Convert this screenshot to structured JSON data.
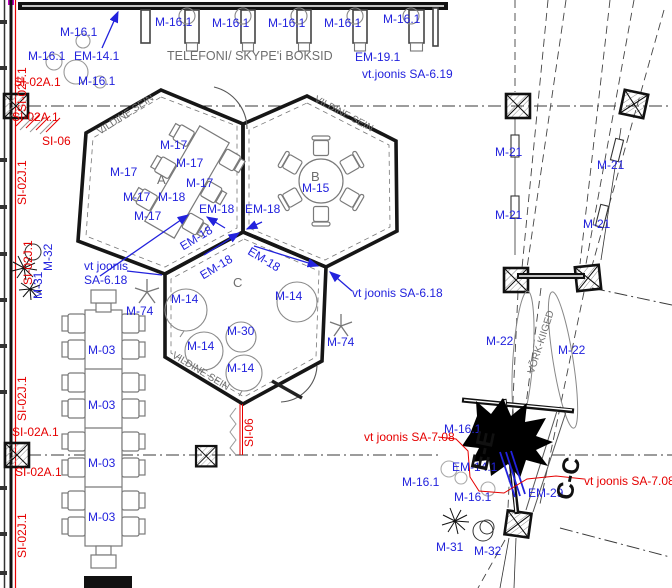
{
  "colors": {
    "annotation_blue": "#2222dd",
    "annotation_red": "#e60000",
    "annotation_gray": "#6e6e6e",
    "wall_black": "#161616",
    "wall_tick_magenta": "#c400c4"
  },
  "rooms": [
    "A",
    "B",
    "C"
  ],
  "phone_booths": {
    "title": "TELEFONI/ SKYPE'i BOKSID",
    "booth_label": "M-16.1",
    "booth_count": 5,
    "reference": "EM-19.1",
    "reference_note": "vt.joonis SA-6.19"
  },
  "annotations": {
    "top_left": [
      {
        "t": "M-16.1",
        "x": 60,
        "y": 26,
        "c": "blue"
      },
      {
        "t": "M-16.1",
        "x": 28,
        "y": 50,
        "c": "blue"
      },
      {
        "t": "EM-14.1",
        "x": 74,
        "y": 50,
        "c": "blue"
      },
      {
        "t": "M-16.1",
        "x": 78,
        "y": 75,
        "c": "blue"
      },
      {
        "t": "SI-02A.1",
        "x": 14,
        "y": 76,
        "c": "red"
      },
      {
        "t": "SI-02A.1",
        "x": 12,
        "y": 111,
        "c": "red"
      },
      {
        "t": "SI-06",
        "x": 42,
        "y": 135,
        "c": "red"
      },
      {
        "t": "SI-02F.1",
        "x": 16,
        "y": 112,
        "c": "red",
        "r": -90
      }
    ],
    "booth_row": [
      {
        "t": "M-16.1",
        "x": 155,
        "y": 16,
        "c": "blue"
      },
      {
        "t": "M-16.1",
        "x": 212,
        "y": 17,
        "c": "blue"
      },
      {
        "t": "M-16.1",
        "x": 268,
        "y": 17,
        "c": "blue"
      },
      {
        "t": "M-16.1",
        "x": 324,
        "y": 17,
        "c": "blue"
      },
      {
        "t": "M-16.1",
        "x": 383,
        "y": 13,
        "c": "blue"
      },
      {
        "t": "TELEFONI/ SKYPE'i BOKSID",
        "x": 167,
        "y": 50,
        "c": "gray",
        "s": 12.5
      },
      {
        "t": "EM-19.1",
        "x": 355,
        "y": 51,
        "c": "blue"
      },
      {
        "t": "vt.joonis SA-6.19",
        "x": 362,
        "y": 68,
        "c": "blue"
      }
    ],
    "left_wall": [
      {
        "t": "SI-02J.1",
        "x": 16,
        "y": 205,
        "c": "red",
        "r": -90
      },
      {
        "t": "SI-02J.1",
        "x": 22,
        "y": 285,
        "c": "red",
        "r": -90
      },
      {
        "t": "M-31",
        "x": 32,
        "y": 299,
        "c": "blue",
        "r": -90
      },
      {
        "t": "M-32",
        "x": 42,
        "y": 271,
        "c": "blue",
        "r": -90
      },
      {
        "t": "SI-02J.1",
        "x": 16,
        "y": 421,
        "c": "red",
        "r": -90
      },
      {
        "t": "SI-02A.1",
        "x": 12,
        "y": 426,
        "c": "red"
      },
      {
        "t": "SI-02A.1",
        "x": 15,
        "y": 466,
        "c": "red"
      },
      {
        "t": "SI-02J.1",
        "x": 16,
        "y": 558,
        "c": "red",
        "r": -90
      }
    ],
    "hex_a": [
      {
        "t": "VILDINE SEIN",
        "x": 96,
        "y": 129,
        "c": "gray",
        "r": -33,
        "s": 10
      },
      {
        "t": "A",
        "x": 157,
        "y": 173,
        "c": "gray",
        "s": 13
      },
      {
        "t": "M-17",
        "x": 160,
        "y": 139,
        "c": "blue"
      },
      {
        "t": "M-17",
        "x": 110,
        "y": 166,
        "c": "blue"
      },
      {
        "t": "M-17",
        "x": 176,
        "y": 157,
        "c": "blue"
      },
      {
        "t": "M-17",
        "x": 186,
        "y": 177,
        "c": "blue"
      },
      {
        "t": "M-17",
        "x": 123,
        "y": 191,
        "c": "blue"
      },
      {
        "t": "M-17",
        "x": 134,
        "y": 210,
        "c": "blue"
      },
      {
        "t": "M-18",
        "x": 158,
        "y": 191,
        "c": "blue"
      }
    ],
    "hex_b": [
      {
        "t": "VILDINE SEIN",
        "x": 317,
        "y": 95,
        "c": "gray",
        "r": 28,
        "s": 10
      },
      {
        "t": "B",
        "x": 311,
        "y": 170,
        "c": "gray",
        "s": 13
      },
      {
        "t": "M-15",
        "x": 302,
        "y": 182,
        "c": "blue"
      }
    ],
    "hex_c": [
      {
        "t": "C",
        "x": 233,
        "y": 276,
        "c": "gray",
        "s": 13
      },
      {
        "t": "EM-18",
        "x": 199,
        "y": 203,
        "c": "blue"
      },
      {
        "t": "EM-18",
        "x": 245,
        "y": 203,
        "c": "blue"
      },
      {
        "t": "EM-18",
        "x": 178,
        "y": 242,
        "c": "blue",
        "r": -31
      },
      {
        "t": "EM-18",
        "x": 198,
        "y": 271,
        "c": "blue",
        "r": -31
      },
      {
        "t": "EM-18",
        "x": 252,
        "y": 245,
        "c": "blue",
        "r": 31
      },
      {
        "t": "vt joonis",
        "x": 84,
        "y": 260,
        "c": "blue"
      },
      {
        "t": "SA-6.18",
        "x": 84,
        "y": 274,
        "c": "blue"
      },
      {
        "t": "vt joonis SA-6.18",
        "x": 352,
        "y": 287,
        "c": "blue"
      },
      {
        "t": "M-74",
        "x": 126,
        "y": 305,
        "c": "blue"
      },
      {
        "t": "M-74",
        "x": 327,
        "y": 336,
        "c": "blue"
      },
      {
        "t": "M-14",
        "x": 171,
        "y": 293,
        "c": "blue"
      },
      {
        "t": "M-14",
        "x": 275,
        "y": 290,
        "c": "blue"
      },
      {
        "t": "M-30",
        "x": 227,
        "y": 325,
        "c": "blue"
      },
      {
        "t": "M-14",
        "x": 187,
        "y": 340,
        "c": "blue"
      },
      {
        "t": "M-14",
        "x": 227,
        "y": 362,
        "c": "blue"
      },
      {
        "t": "VILDINE SEIN",
        "x": 175,
        "y": 351,
        "c": "gray",
        "r": 31,
        "s": 10
      },
      {
        "t": "SI-06",
        "x": 243,
        "y": 447,
        "c": "red",
        "r": -90
      }
    ],
    "long_table": [
      {
        "t": "M-03",
        "x": 88,
        "y": 344,
        "c": "blue"
      },
      {
        "t": "M-03",
        "x": 88,
        "y": 399,
        "c": "blue"
      },
      {
        "t": "M-03",
        "x": 88,
        "y": 457,
        "c": "blue"
      },
      {
        "t": "M-03",
        "x": 88,
        "y": 511,
        "c": "blue"
      }
    ],
    "right_zone": [
      {
        "t": "M-21",
        "x": 495,
        "y": 146,
        "c": "blue"
      },
      {
        "t": "M-21",
        "x": 597,
        "y": 159,
        "c": "blue"
      },
      {
        "t": "M-21",
        "x": 495,
        "y": 209,
        "c": "blue"
      },
      {
        "t": "M-21",
        "x": 583,
        "y": 218,
        "c": "blue"
      },
      {
        "t": "M-22",
        "x": 486,
        "y": 335,
        "c": "blue"
      },
      {
        "t": "M-22",
        "x": 558,
        "y": 344,
        "c": "blue"
      },
      {
        "t": "VÕRK-KIIGED",
        "x": 527,
        "y": 372,
        "c": "gray",
        "r": -72,
        "s": 10
      }
    ],
    "bottom_right": [
      {
        "t": "vt joonis SA-7.08",
        "x": 364,
        "y": 431,
        "c": "red"
      },
      {
        "t": "vt joonis SA-7.08",
        "x": 584,
        "y": 475,
        "c": "red"
      },
      {
        "t": "M-16.1",
        "x": 444,
        "y": 423,
        "c": "blue"
      },
      {
        "t": "EM-14.1",
        "x": 452,
        "y": 461,
        "c": "blue"
      },
      {
        "t": "M-16.1",
        "x": 402,
        "y": 476,
        "c": "blue"
      },
      {
        "t": "M-16.1",
        "x": 454,
        "y": 491,
        "c": "blue"
      },
      {
        "t": "EM-29",
        "x": 528,
        "y": 487,
        "c": "blue"
      },
      {
        "t": "M-31",
        "x": 436,
        "y": 541,
        "c": "blue"
      },
      {
        "t": "M-32",
        "x": 474,
        "y": 545,
        "c": "blue"
      },
      {
        "t": "E-E",
        "x": 468,
        "y": 468,
        "c": "black",
        "r": -78,
        "s": 24,
        "b": 1
      },
      {
        "t": "C-C",
        "x": 553,
        "y": 497,
        "c": "black",
        "r": -78,
        "s": 24,
        "b": 1
      }
    ]
  }
}
